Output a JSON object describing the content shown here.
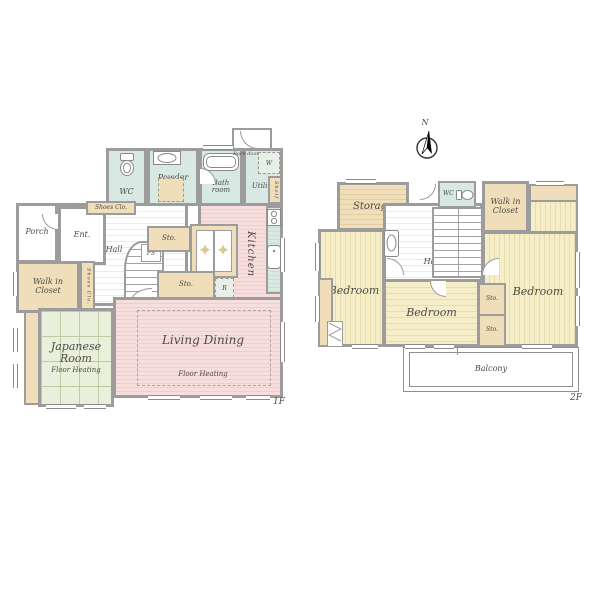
{
  "palette": {
    "wall": "#9c9c9c",
    "sanitary_green": "#d8e8e2",
    "closet_beige": "#f0ddb9",
    "living_pink": "#f7dddb",
    "tatami_green": "#e9efdb",
    "bedroom_yellow": "#f5eec8",
    "label_ink": "#4c4c45"
  },
  "floor1": {
    "label": "1F",
    "wc": "WC",
    "powder_room": "Powder room",
    "bath_room": "Bath room",
    "utility": "Utility",
    "shelf": "Shelf",
    "washer": "W",
    "back_door": "Back door",
    "shoes_closet_top": "Shoes Clo.",
    "porch": "Porch",
    "entrance": "Ent.",
    "hall": "Hall",
    "walk_in_closet": "Walk in Closet",
    "shoes_closet_side": "Shoes Clo.",
    "storage_small": "Sto.",
    "pipe_space": "PS",
    "kitchen": "Kitchen",
    "refrigerator": "R",
    "storage_mid": "Sto.",
    "living_dining": "Living Dining",
    "living_floor_heating": "Floor Heating",
    "japanese_room": "Japanese Room",
    "japanese_floor_heating": "Floor Heating",
    "decor_star": "✦"
  },
  "floor2": {
    "label": "2F",
    "north": "N",
    "storage": "Storage",
    "wc": "WC",
    "walk_in_closet": "Walk in Closet",
    "hall": "Hall",
    "bedroom_left": "Bedroom",
    "bedroom_mid": "Bedroom",
    "bedroom_right": "Bedroom",
    "storage_upper": "Sto.",
    "storage_lower": "Sto.",
    "balcony": "Balcony"
  }
}
